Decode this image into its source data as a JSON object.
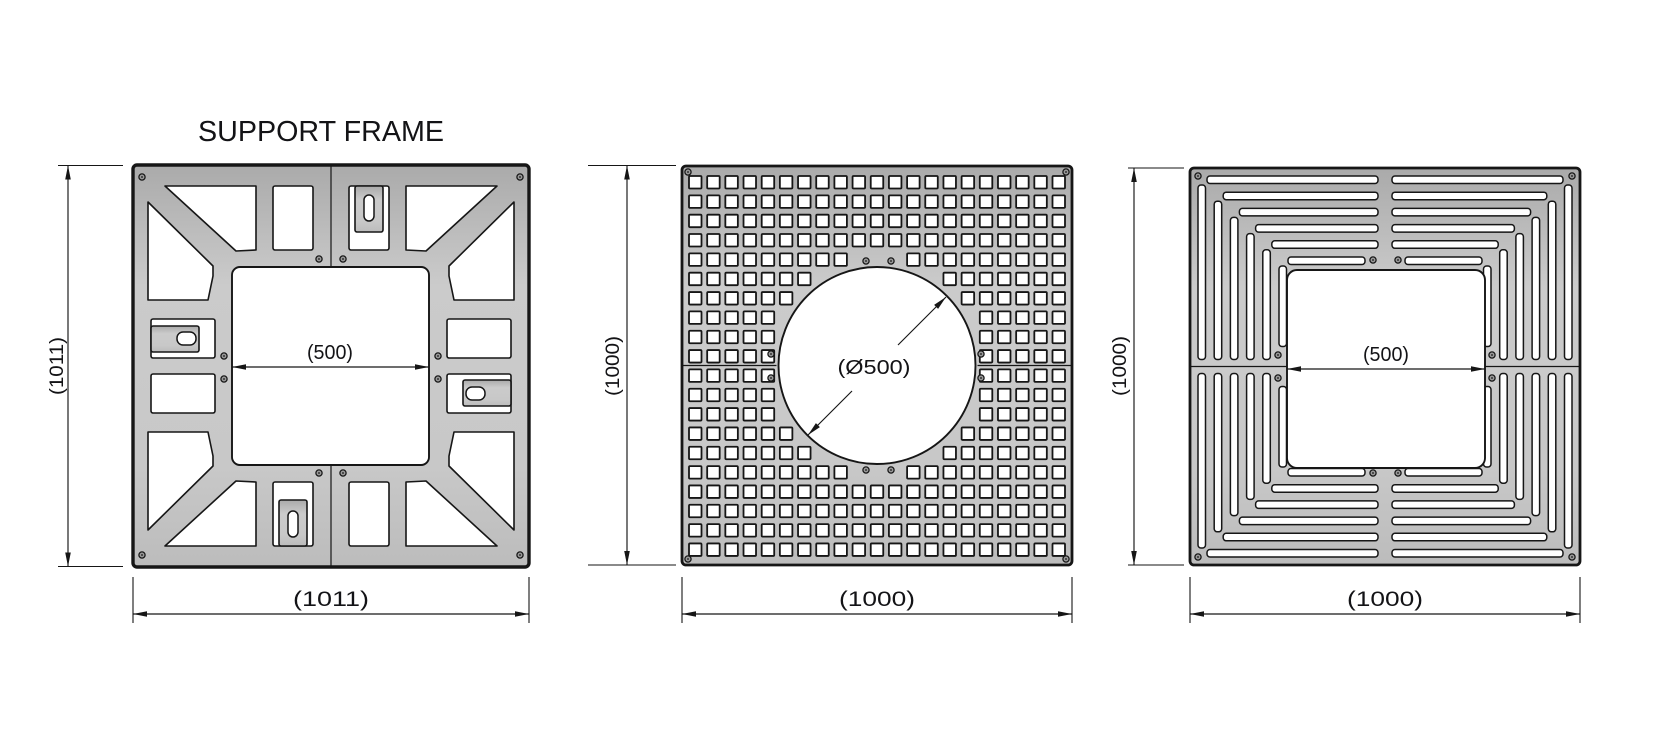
{
  "page": {
    "background": "#ffffff"
  },
  "colors": {
    "background": "#ffffff",
    "line": "#161616",
    "text": "#131316",
    "metal_light": "#cbcbcb",
    "metal_mid": "#c2c2c2",
    "metal_dark": "#a9a9a9",
    "cutout": "#ffffff",
    "hole_center": "#9a9a9a"
  },
  "drawings": {
    "support_frame": {
      "title": "SUPPORT FRAME",
      "height_label": "(1011)",
      "width_label": "(1011)",
      "opening_width_label": "(500)"
    },
    "perforated_grate": {
      "height_label": "(1000)",
      "width_label": "(1000)",
      "hole_diameter_label": "(Ø500)"
    },
    "slatted_grate": {
      "height_label": "(1000)",
      "width_label": "(1000)",
      "opening_width_label": "(500)"
    }
  }
}
